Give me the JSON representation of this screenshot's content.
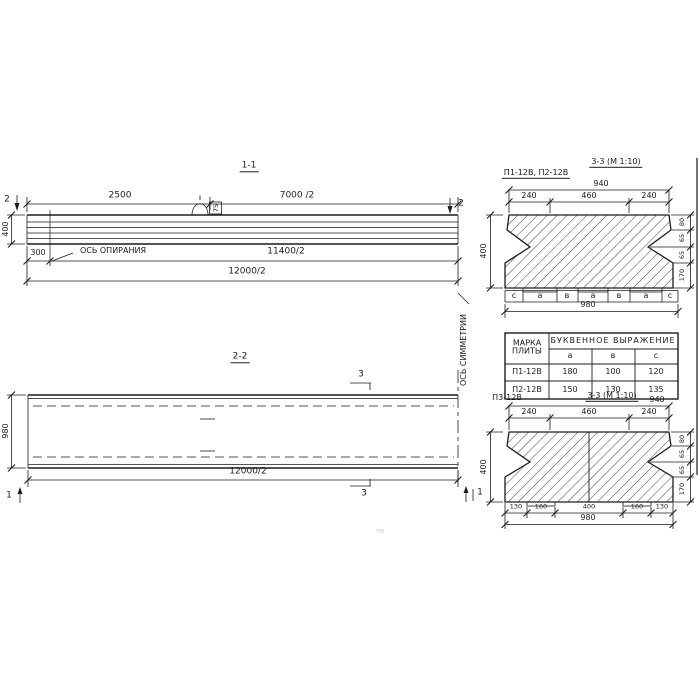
{
  "colors": {
    "ink": "#1c1c1c",
    "paper": "#ffffff"
  },
  "s11": {
    "title": "1-1",
    "cut2": "2",
    "top_dims": [
      "2500",
      "7000 /2"
    ],
    "h_dim": "400",
    "support_offset": "300",
    "support_axis": "ОСЬ ОПИРАНИЯ",
    "dim_11400": "11400/2",
    "dim_12000": "12000/2",
    "loop_label": "75"
  },
  "s22": {
    "title": "2-2",
    "cut3": "3",
    "cut1": "1",
    "w_dim": "980",
    "dim_12000": "12000/2",
    "symmetry": "ОСЬ СИММЕТРИИ"
  },
  "s33a": {
    "label": "П1-12В, П2-12В",
    "title": "3-3 (М 1:10)",
    "total_top": "940",
    "top_dims": [
      "240",
      "460",
      "240"
    ],
    "left_dim": "400",
    "right_dims": [
      "80",
      "65",
      "65",
      "170"
    ],
    "letters": [
      "с",
      "а",
      "в",
      "а",
      "в",
      "а",
      "с"
    ],
    "bottom_dim": "980"
  },
  "table": {
    "mark_header": "МАРКА\nПЛИТЫ",
    "group_header": "БУКВЕННОЕ  ВЫРАЖЕНИЕ",
    "col_headers": [
      "а",
      "в",
      "с"
    ],
    "rows": [
      {
        "mark": "П1-12В",
        "vals": [
          "180",
          "100",
          "120"
        ]
      },
      {
        "mark": "П2-12В",
        "vals": [
          "150",
          "130",
          "135"
        ]
      }
    ]
  },
  "s33b": {
    "label": "П3-12В",
    "title": "3-3 (М 1:10)",
    "total_top": "940",
    "top_dims": [
      "240",
      "460",
      "240"
    ],
    "left_dim": "400",
    "right_dims": [
      "80",
      "65",
      "65",
      "170"
    ],
    "bottom_dims": [
      "130",
      "160",
      "400",
      "160",
      "130"
    ],
    "bottom_dim": "980"
  },
  "faint_note": "пв"
}
